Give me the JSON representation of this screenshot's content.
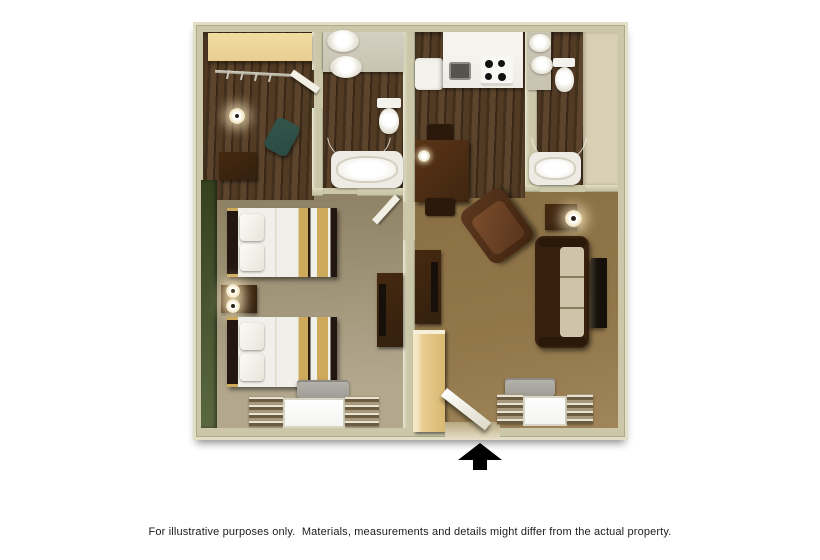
{
  "palette": {
    "bg": "#ffffff",
    "wall": "#cbc7a8",
    "wall-edge": "#e3dfc6",
    "green-wall": "#44502c",
    "carpet-living": "#92774b",
    "fixture-white": "#f4f2ec",
    "counter-gray": "#c9c3b2",
    "counter-white": "#edebe3",
    "stripe-tan": "#cda95c",
    "furniture-dark": "#33200f",
    "sofa-frame": "#38200f",
    "cushion": "#cfc3a9",
    "tv-black": "#17100a",
    "light-wood": "#e9ce92",
    "ptac-gray": "#a09d96",
    "drape-dark": "#6b5c42",
    "drape-light": "#e8e2d2",
    "chair-teal": "#2a4a42",
    "arrow-black": "#000000",
    "disclaimer-color": "#1c1c1c"
  },
  "floorplan": {
    "type": "hotel-suite-floor-plan",
    "rooms": [
      {
        "name": "bedroom",
        "features": [
          "closet-shelf",
          "hanger-rod",
          "wall-lamp",
          "desk",
          "desk-chair",
          "two-double-beds",
          "nightstand-with-lamps",
          "dresser-with-tv",
          "green-accent-wall",
          "window-with-drapes",
          "ptac-unit"
        ]
      },
      {
        "name": "bathroom-1",
        "features": [
          "double-sink-vanity",
          "toilet",
          "bathtub",
          "door-swing-arc"
        ]
      },
      {
        "name": "kitchen",
        "features": [
          "refrigerator",
          "counter",
          "sink",
          "stove",
          "dining-table",
          "two-chairs",
          "candle"
        ]
      },
      {
        "name": "bathroom-2",
        "features": [
          "sink-vanity",
          "toilet",
          "bathtub",
          "door-swing-arc"
        ]
      },
      {
        "name": "living-room",
        "features": [
          "armchair",
          "side-table-with-lamp",
          "sofa",
          "wall-tv",
          "dresser-with-tv",
          "tall-cabinet",
          "entry-door",
          "window-with-drapes",
          "ptac-unit"
        ]
      }
    ],
    "entrance_arrow_icon": "triangle-up-with-stem"
  },
  "footer": {
    "disclaimer": "For illustrative purposes only.  Materials, measurements and details might differ from the actual property."
  }
}
